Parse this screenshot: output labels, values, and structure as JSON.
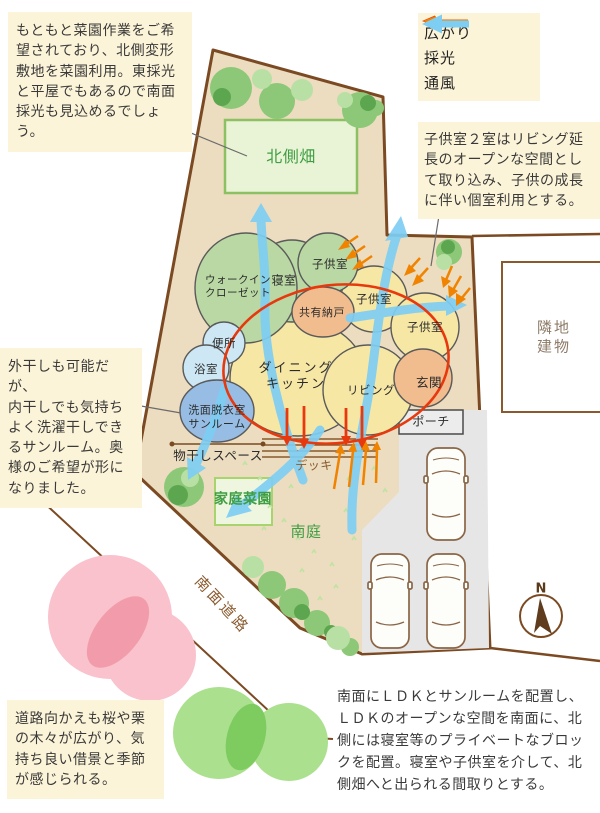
{
  "palette": {
    "site_fill": "#ecdcc0",
    "boundary": "#7b4a22",
    "room_green": "#b9d8a3",
    "room_yellow": "#f7e7a5",
    "room_orange": "#f2bd8e",
    "room_blue_light": "#cde8f4",
    "room_blue": "#97bde4",
    "bubble_outline": "#5a5a5a",
    "parking": "#e6e6e6",
    "porch": "#ececec",
    "field_fill": "#e9f3d6",
    "field_border": "#8cc163",
    "garden_fill": "#f0f8e2",
    "garden_border": "#a9d36e",
    "green_text": "#3f9e43",
    "brown_text": "#8a5a2e",
    "note_bg": "#fcf4d8",
    "spread_red": "#e8380d",
    "light_orange": "#f08300",
    "wind_blue": "#7ecef4",
    "tree_green": "#8cc878",
    "tree_green_dark": "#5da650",
    "tree_green_light": "#b8e0a4",
    "grass": "#bfe3a1",
    "cherry_pink": "#f9c2cd",
    "cherry_pink_dark": "#f29cab",
    "grove_green": "#abe08f",
    "grove_green_dark": "#7ecb5f",
    "car_brown": "#8a6546",
    "compass_brown": "#5f3c1e"
  },
  "notes": {
    "garden_plan": "もともと菜園作業をご希\n望されており、北側変形\n敷地を菜園利用。東採光\nと平屋でもあるので南面\n採光も見込めるでしょう。",
    "kids_rooms": "子供室２室はリビング延\n長のオープンな空間とし\nて取り込み、子供の成長\nに伴い個室利用とする。",
    "sunroom": "外干しも可能だが、\n内干しでも気持ち\nよく洗濯干しでき\nるサンルーム。奥\n様のご希望が形に\nなりました。",
    "borrowed_scenery": "道路向かえも桜や栗\nの木々が広がり、気\n持ち良い借景と季節\nが感じられる。",
    "summary": "南面にＬＤＫとサンルームを配置し、\nＬＤＫのオープンな空間を南面に、北\n側には寝室等のプライベートなブロッ\nクを配置。寝室や子供室を介して、北\n側畑へと出られる間取りとする。"
  },
  "legend": {
    "items": [
      {
        "label": "広がり",
        "color": "#e8380d"
      },
      {
        "label": "採光",
        "color": "#f08300"
      },
      {
        "label": "通風",
        "color": "#7ecef4"
      }
    ]
  },
  "plan": {
    "north_field": "北側畑",
    "neighbor_building": "隣地建物",
    "south_road": "南面道路",
    "south_garden": "南庭",
    "kitchen_garden": "家庭菜園",
    "drying_space": "物干しスペース",
    "deck": "デッキ",
    "porch": "ポーチ",
    "compass": "N",
    "rooms": {
      "wic": "ウォークイン\nクローゼット",
      "bedroom": "寝室",
      "kids_north": "子供室",
      "kids_east": "子供室",
      "kids_southeast": "子供室",
      "shared_storage": "共有納戸",
      "toilet": "便所",
      "bath": "浴室",
      "sunroom": "洗面脱衣室\nサンルーム",
      "dining_kitchen": "ダイニング\nキッチン",
      "living": "リビング",
      "entrance": "玄関"
    }
  }
}
